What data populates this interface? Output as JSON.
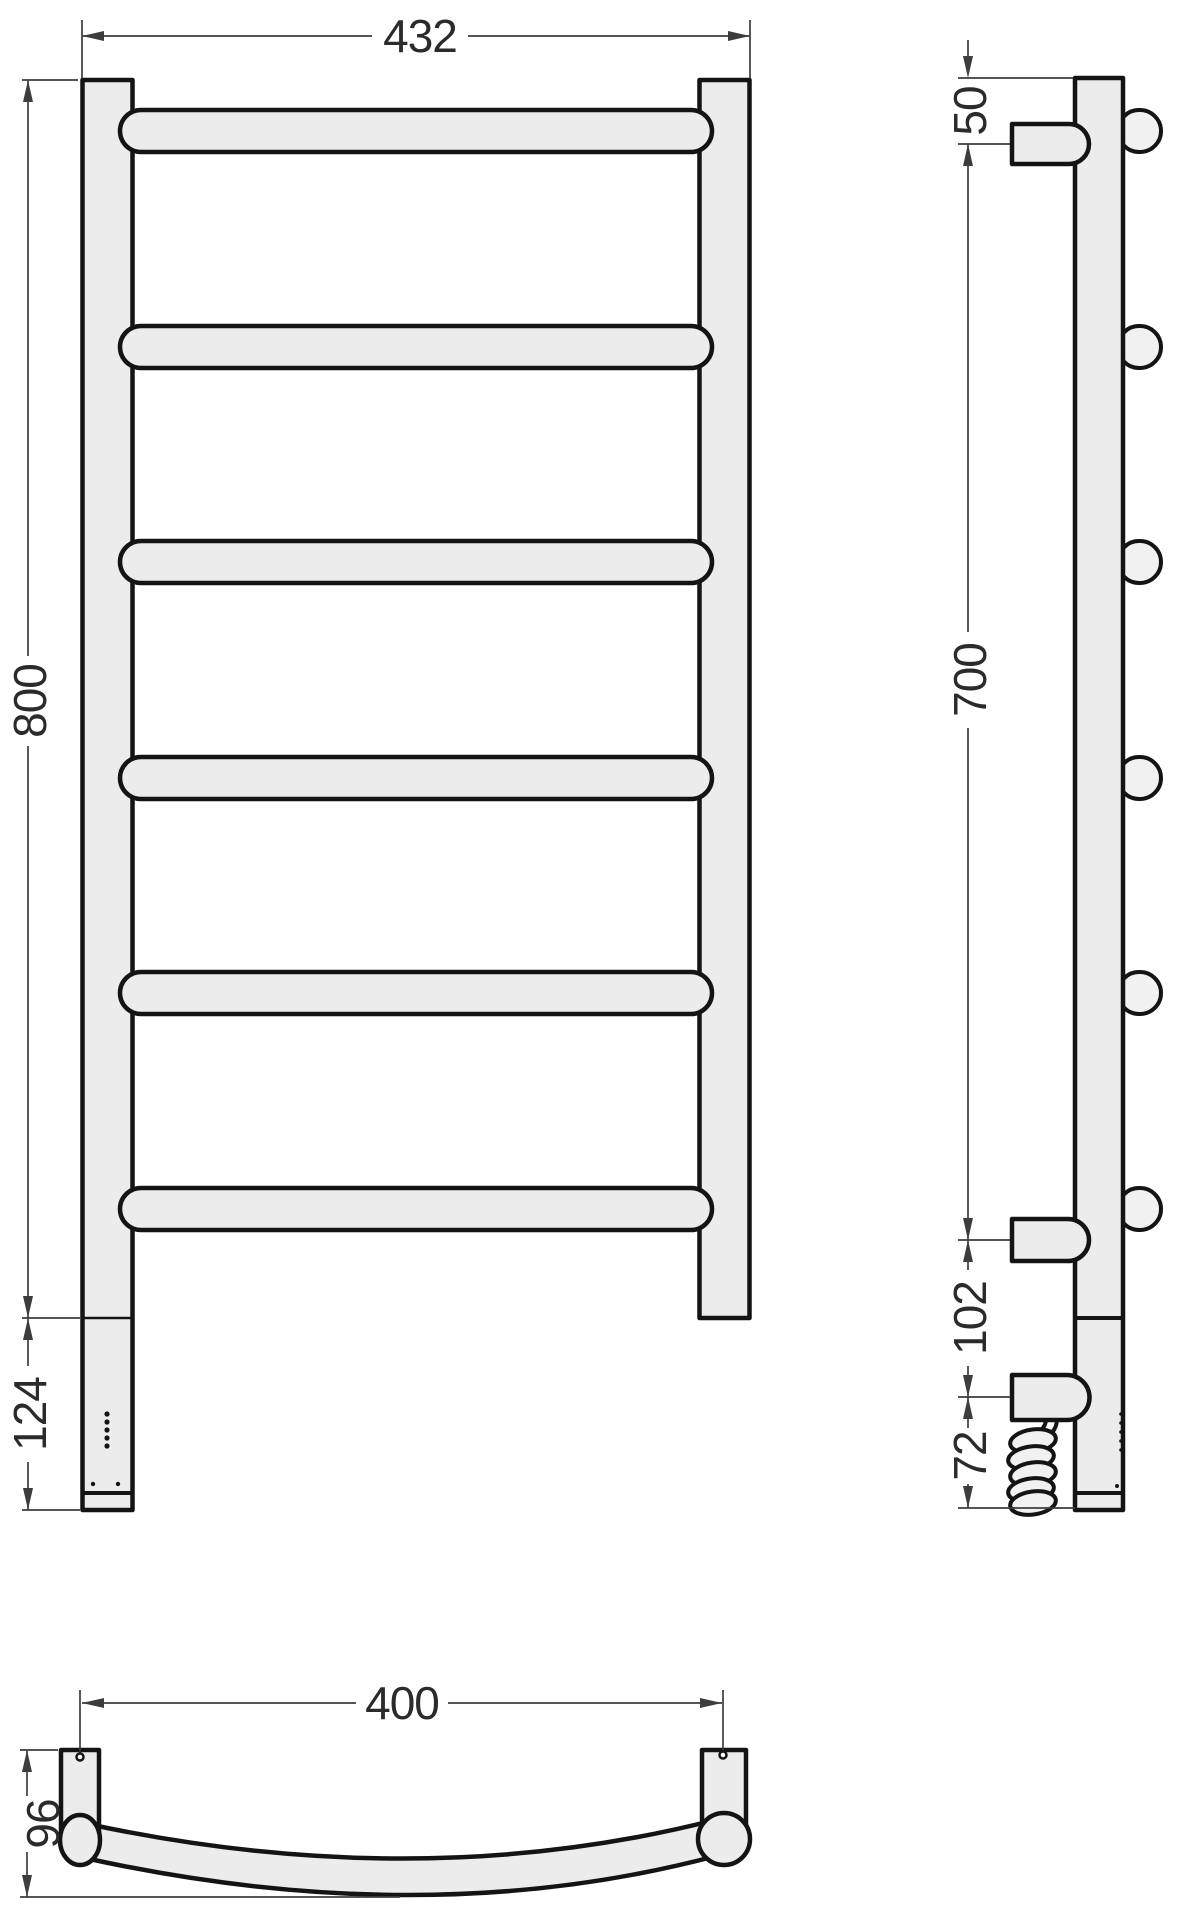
{
  "drawing": {
    "type": "technical-drawing",
    "subject": "ladder towel rail dryer, three orthographic views with dimensions",
    "colors": {
      "part_fill": "#ececec",
      "part_fill_light": "#f1f1f1",
      "outline": "#141414",
      "dim_line": "#3d3d3d",
      "dim_text": "#2b2b2b",
      "background": "#ffffff"
    },
    "front_view": {
      "overall_width_mm": "432",
      "overall_height_mm": "800",
      "heater_section_mm": "124",
      "rung_count": 6
    },
    "side_view": {
      "top_to_bracket_mm": "50",
      "bracket_span_mm": "700",
      "bracket_to_connector_mm": "102",
      "cable_drop_mm": "72",
      "rung_end_count": 6
    },
    "bottom_view": {
      "mounting_span_mm": "400",
      "depth_mm": "96"
    }
  }
}
